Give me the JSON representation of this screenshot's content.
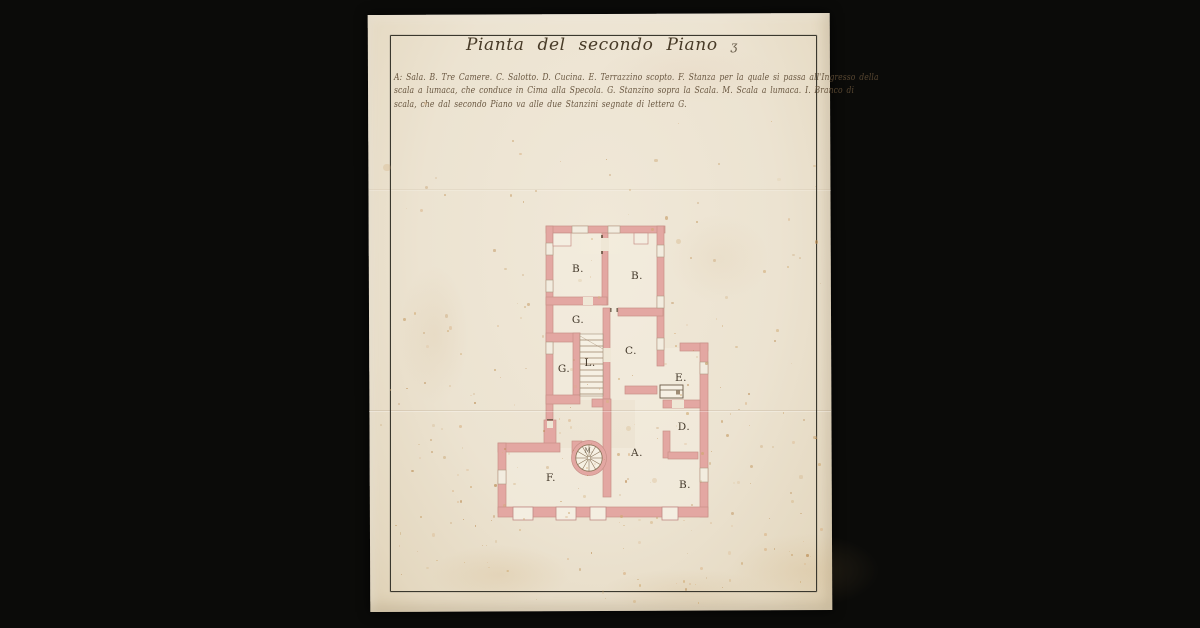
{
  "document": {
    "title": "Pianta del secondo Piano",
    "title_flourish": "ʒ",
    "legend_lines": [
      "A: Sala. B. Tre Camere. C. Salotto. D. Cucina. E. Terrazzino scopto. F. Stanza per la quale si passa all'Ingresso della",
      "scala a lumaca, che conduce in Cima alla Specola. G. Stanzino sopra la Scala. M. Scala a lumaca. I. Branco di",
      "scala, che dal secondo Piano va alle due Stanzini segnate di lettera G."
    ]
  },
  "plan": {
    "labels": [
      {
        "name": "room-label-b-upper-left",
        "text": "B.",
        "x": 578,
        "y": 269
      },
      {
        "name": "room-label-b-upper-right",
        "text": "B.",
        "x": 637,
        "y": 276
      },
      {
        "name": "room-label-g-upper",
        "text": "G.",
        "x": 578,
        "y": 320
      },
      {
        "name": "room-label-g-lower",
        "text": "G.",
        "x": 564,
        "y": 369
      },
      {
        "name": "room-label-l-staircase",
        "text": "L.",
        "x": 590,
        "y": 363
      },
      {
        "name": "room-label-c-salotto",
        "text": "C.",
        "x": 631,
        "y": 351
      },
      {
        "name": "room-label-e-terrazzino",
        "text": "E.",
        "x": 681,
        "y": 378
      },
      {
        "name": "room-label-d-cucina",
        "text": "D.",
        "x": 684,
        "y": 427
      },
      {
        "name": "room-label-a-sala",
        "text": "A.",
        "x": 637,
        "y": 453
      },
      {
        "name": "room-label-b-lower",
        "text": "B.",
        "x": 685,
        "y": 485
      },
      {
        "name": "room-label-f-stanza",
        "text": "F.",
        "x": 551,
        "y": 478
      },
      {
        "name": "room-label-m-spiral",
        "text": "M.",
        "x": 589,
        "y": 451,
        "small": true
      }
    ]
  },
  "colors": {
    "background": "#0b0b09",
    "paper": "#ece3d1",
    "frame_line": "#3a382e",
    "title_ink": "#473a27",
    "legend_ink": "#5e4b34",
    "wall_pink": "#e3a7a2",
    "wall_outline": "#c89088",
    "plan_ink": "#8a7358",
    "foxing_palette": [
      "#cfa870",
      "#d9b285",
      "#b9894f",
      "#c49a62"
    ]
  }
}
